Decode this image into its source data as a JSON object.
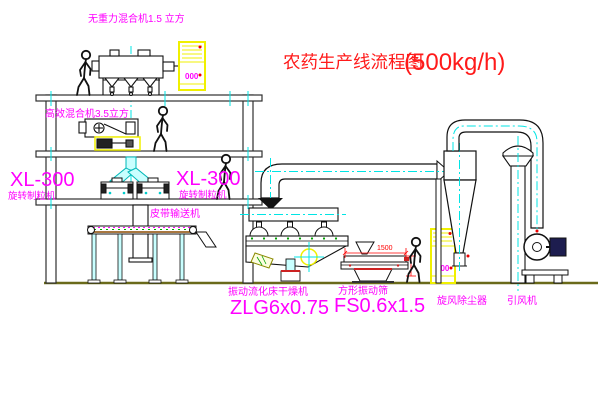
{
  "title": {
    "text_cn": "农药生产线流程图",
    "text_capacity": "(500kg/h)"
  },
  "labels": {
    "gravity_mixer": "无重力混合机1.5 立方",
    "high_mixer": "高效混合机3.5立方",
    "granulator_left_model": "XL-300",
    "granulator_left_name": "旋转制粒机",
    "granulator_right_model": "XL-300",
    "granulator_right_name": "旋转制粒机",
    "belt_conveyor": "皮带输送机",
    "dryer_name": "振动流化床干燥机",
    "dryer_model": "ZLG6x0.75",
    "screen_name": "方形振动筛",
    "screen_model": "FS0.6x1.5",
    "cyclone_name": "旋风除尘器",
    "fan_name": "引风机",
    "dim_width": "1500",
    "cabinet1_display": "000",
    "cabinet2_display": "000"
  },
  "colors": {
    "label_magenta": "#ff00ff",
    "title_red": "#ff1a1a",
    "cabinet_yellow": "#f0f000",
    "centerline_cyan": "#00e5e5",
    "dimension_red": "#ff0000",
    "structure_dark": "#2f2f2f",
    "ground_olive": "#6a6a1a",
    "bolt_green": "#00a000",
    "belt_brown": "#8b4a00"
  }
}
